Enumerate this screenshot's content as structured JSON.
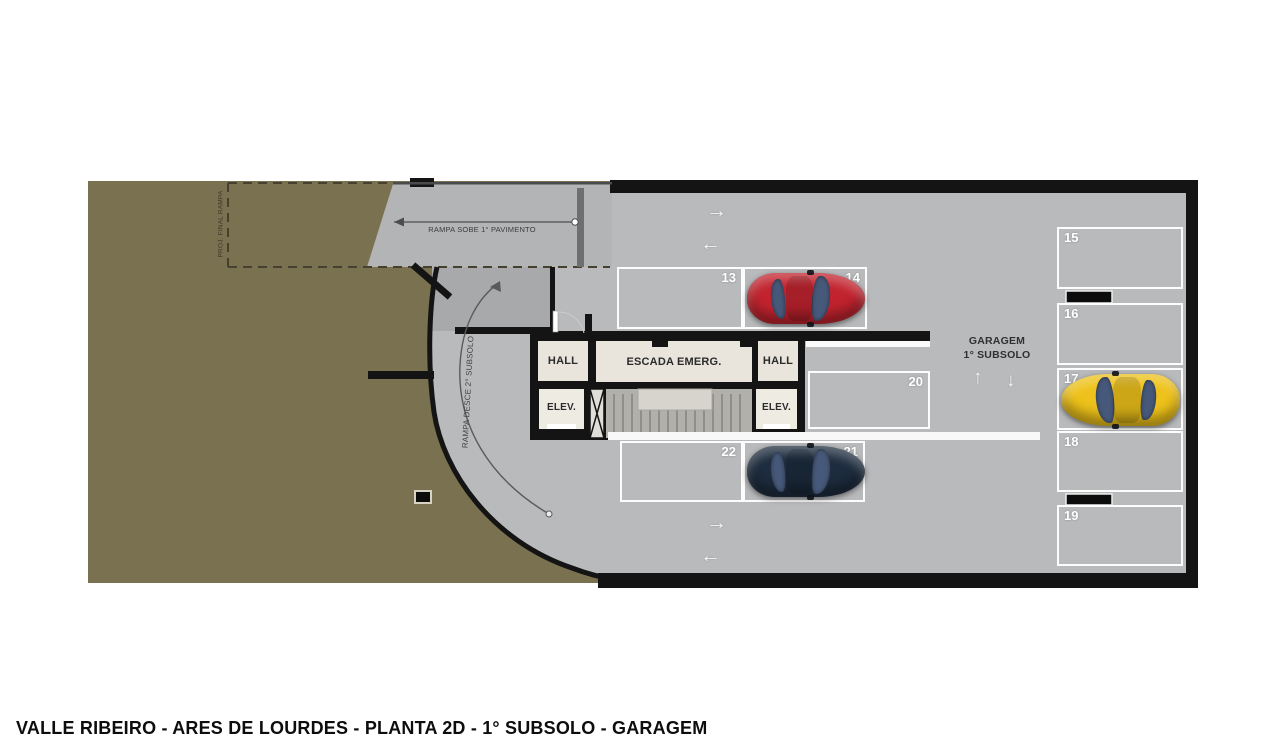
{
  "title": "VALLE RIBEIRO - ARES DE LOURDES - PLANTA 2D - 1° SUBSOLO - GARAGEM",
  "plan": {
    "labels": {
      "garage_line1": "GARAGEM",
      "garage_line2": "1° SUBSOLO",
      "ramp_up": "RAMPA SOBE 1° PAVIMENTO",
      "ramp_down": "RAMPA DESCE 2° SUBSOLO",
      "ramp_projection": "PROJ. FINAL RAMPA",
      "hall": "HALL",
      "stairs": "ESCADA EMERG.",
      "elevator": "ELEV."
    },
    "arrows": {
      "right": "→",
      "left": "←",
      "up": "↑",
      "down": "↓"
    }
  },
  "parking_spots": [
    {
      "number": "13",
      "occupied": false
    },
    {
      "number": "14",
      "occupied": true,
      "car": "red"
    },
    {
      "number": "15",
      "occupied": false
    },
    {
      "number": "16",
      "occupied": false
    },
    {
      "number": "17",
      "occupied": true,
      "car": "yellow"
    },
    {
      "number": "18",
      "occupied": false
    },
    {
      "number": "19",
      "occupied": false
    },
    {
      "number": "20",
      "occupied": false
    },
    {
      "number": "21",
      "occupied": true,
      "car": "dark-blue"
    },
    {
      "number": "22",
      "occupied": false
    }
  ],
  "colors": {
    "terrain": "#7a7150",
    "floor": "#b9babc",
    "ramp_floor": "#b3b4b6",
    "down_ramp": "#a8a9ab",
    "wall": "#141414",
    "room": "#e9e5dc",
    "stair": "#b2b0ab",
    "landing": "#d7d4cd",
    "car_red": "#c2232e",
    "car_yellow": "#eec21a",
    "car_dark": "#1d2c3e",
    "car_glass": "#47597a",
    "arrow": "#f2f2f2"
  }
}
